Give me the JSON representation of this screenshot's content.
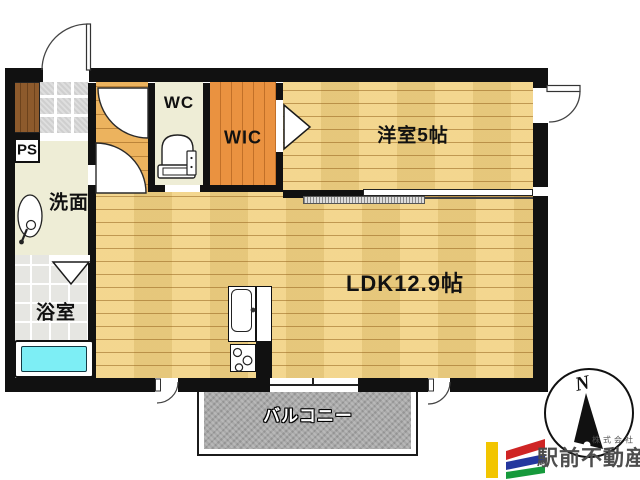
{
  "rooms": {
    "wc": "WC",
    "wic": "WIC",
    "western_room": "洋室5帖",
    "washroom": "洗面",
    "bathroom": "浴室",
    "pipe_space": "PS",
    "ldk": "LDK12.9帖",
    "balcony": "バルコニー"
  },
  "compass": {
    "north": "N"
  },
  "branding": {
    "company_prefix": "株式会社",
    "company_name": "駅前不動産"
  },
  "colors": {
    "wall": "#111111",
    "wood_floor": "#f2d282",
    "hallway_floor": "#ecb35e",
    "wic_floor": "#ea9240",
    "cabinet": "#8d5a2c",
    "genkan_tile": "#dcdcdc",
    "bath_tile": "#e6e6e2",
    "cream_floor": "#eeedd6",
    "bathtub": "#7deef5",
    "balcony": "#a9a9a9",
    "logo_yellow": "#f2c500",
    "logo_red": "#cf2525",
    "logo_blue": "#24379e",
    "logo_green": "#169a3c",
    "logo_text": "#4d4d4d"
  }
}
